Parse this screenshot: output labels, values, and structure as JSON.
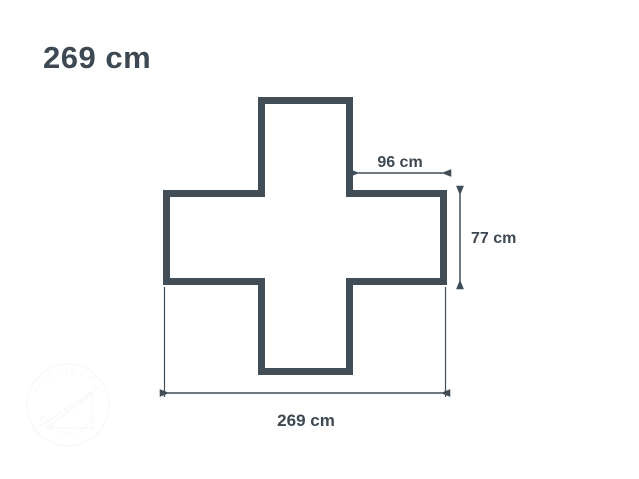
{
  "page": {
    "background_color": "#ffffff"
  },
  "header": {
    "title": "269 cm"
  },
  "diagram": {
    "type": "dimension-drawing",
    "shape": "plus-cross-outline",
    "stroke_color": "#414d57",
    "dimension_labels": {
      "arm_width": "96 cm",
      "arm_height": "77 cm",
      "total_width": "269 cm"
    }
  },
  "watermark": {
    "text": "ARCHIEXPO",
    "color": "#8a9096"
  }
}
